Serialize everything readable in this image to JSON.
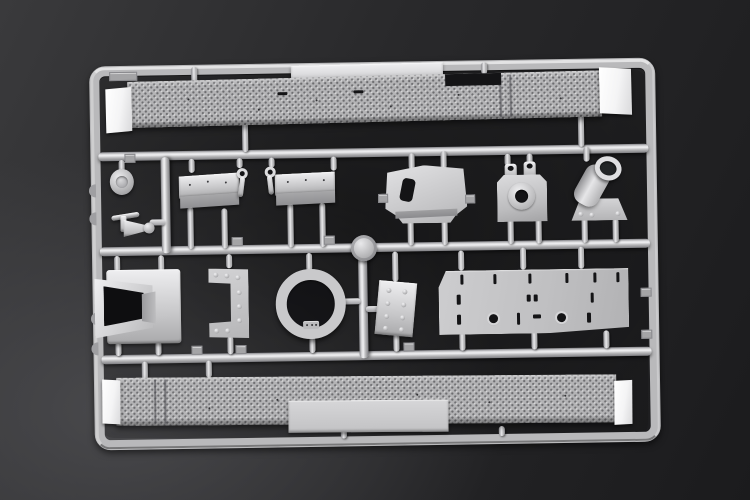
{
  "photo": {
    "subject": "Injection-moulded plastic model kit sprue (parts tree) photographed on a dark backdrop",
    "plastic_finish": "light grey styrene",
    "backdrop": "dark grey gradient studio background",
    "visible_text": "none"
  },
  "colors": {
    "bg_deep": "#1b1b1d",
    "bg_mid": "#29292b",
    "bg_lift": "#49494c",
    "runner": "#b9b9bb",
    "runner_hl": "#efeff1",
    "runner_sh": "#7e7e82",
    "part": "#c6c6c8",
    "part_hl": "#eeeef0",
    "part_sh": "#98989b",
    "tread": "#b4b4b6",
    "cap": "#f4f4f5",
    "hole": "#141416"
  },
  "parts": [
    {
      "name": "sprue-frame",
      "desc": "rounded rectangular outer runner frame with moulded tabs"
    },
    {
      "name": "top-fender-strip",
      "desc": "long treadplate fender strip, white angled end caps, raised smooth plate and notch on top edge"
    },
    {
      "name": "bottom-fender-strip",
      "desc": "long treadplate fender strip with smooth plate attached below, white end caps"
    },
    {
      "name": "hub-disc",
      "desc": "small oval hub cap with recessed centre"
    },
    {
      "name": "tow-coupling",
      "desc": "small coupling: cross arm, tapered cone body and end knob"
    },
    {
      "name": "support-plate-left",
      "desc": "angled rectangular support plate on two curved sprue legs"
    },
    {
      "name": "support-plate-right",
      "desc": "angled rectangular support plate on two curved sprue legs"
    },
    {
      "name": "shackle-hook-left",
      "desc": "small eyelet hook"
    },
    {
      "name": "shackle-hook-right",
      "desc": "small eyelet hook"
    },
    {
      "name": "shield-plate",
      "desc": "wide trapezoidal shield plate with slanted slot cut-out and folded lower lip"
    },
    {
      "name": "cradle-block",
      "desc": "mounting block with two hollow posts and large centre bore"
    },
    {
      "name": "barrel-mount",
      "desc": "angled open tube on trapezoidal bolted base plate"
    },
    {
      "name": "intake-hood",
      "desc": "flared rectangular hood with deep dark opening"
    },
    {
      "name": "riveted-bracket",
      "desc": "C-shaped bracket studded with dome rivets"
    },
    {
      "name": "ring",
      "desc": "large flat circular ring with small notched lug at bottom"
    },
    {
      "name": "bolt-plate",
      "desc": "small tilted plate with two columns of dome bolts"
    },
    {
      "name": "roof-panel",
      "desc": "large flat panel with slots, tick marks and two ringed round openings"
    },
    {
      "name": "runner-node",
      "desc": "round moulding node where centre runners meet"
    }
  ]
}
